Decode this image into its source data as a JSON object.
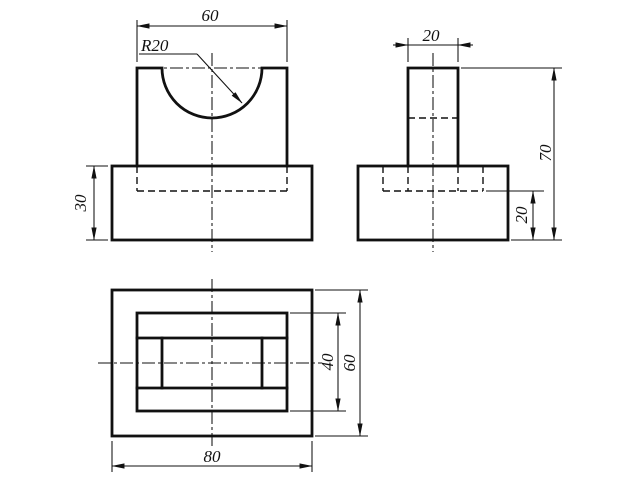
{
  "drawing": {
    "front_view": {
      "width_dim": "60",
      "radius_label": "R20",
      "base_height_dim": "30"
    },
    "side_view": {
      "top_width_dim": "20",
      "total_height_dim": "70",
      "base_recess_dim": "20"
    },
    "top_view": {
      "pocket_depth_dim": "40",
      "overall_depth_dim": "60",
      "overall_width_dim": "80"
    },
    "line_color": "#111111",
    "background_color": "#ffffff"
  }
}
